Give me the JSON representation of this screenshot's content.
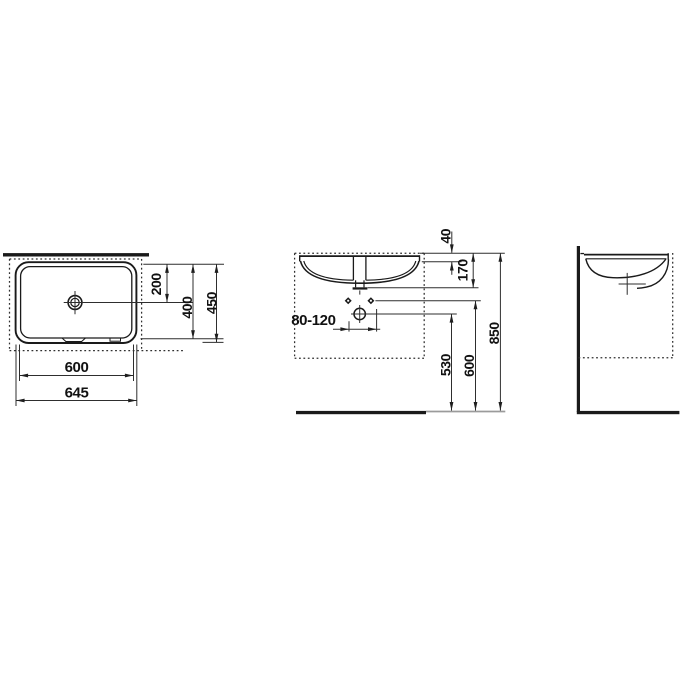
{
  "drawing": {
    "type": "technical-installation-drawing",
    "views": [
      "plan-view",
      "front-view",
      "side-view"
    ],
    "top_view": {
      "drain_offset": "200",
      "basin_depth": "400",
      "overall_depth": "450",
      "basin_width": "600",
      "overall_width": "645"
    },
    "front_view": {
      "rim_height": "40",
      "outlet_depth": "170",
      "connection_range": "80-120",
      "trap_height": "530",
      "fixing_height": "600",
      "rim_level_height": "850"
    },
    "icons": {
      "drain_plan": "drain-crosshair-icon",
      "waste_trap": "waste-trap-circle-icon",
      "fixing_holes": "fixing-hole-diamond-icon"
    },
    "colors": {
      "ink": "#1a1a1a",
      "dim_lines": "#2e2e2e",
      "floor_extension": "#9b9b9b",
      "background": "#ffffff"
    }
  }
}
